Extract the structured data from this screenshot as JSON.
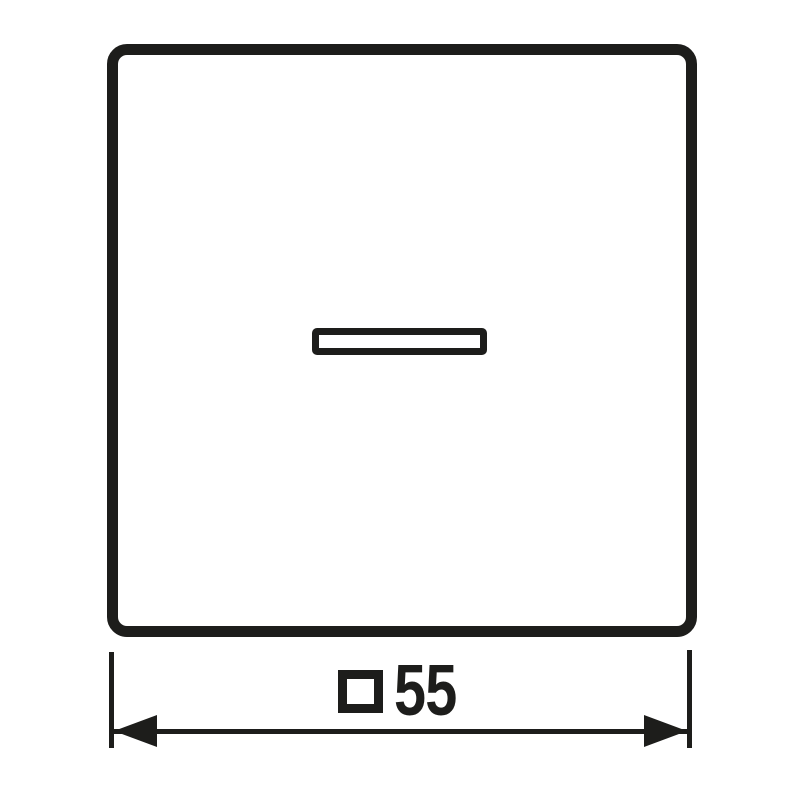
{
  "colors": {
    "line": "#1d1d1b",
    "background": "#ffffff"
  },
  "drawing": {
    "plate": {
      "description": "square rocker cover outline with rounded corners"
    },
    "lens": {
      "description": "horizontal indicator lens window"
    },
    "dimension": {
      "symbol_icon": "square-outline-icon",
      "symbol_char": "□",
      "value": "55"
    }
  }
}
